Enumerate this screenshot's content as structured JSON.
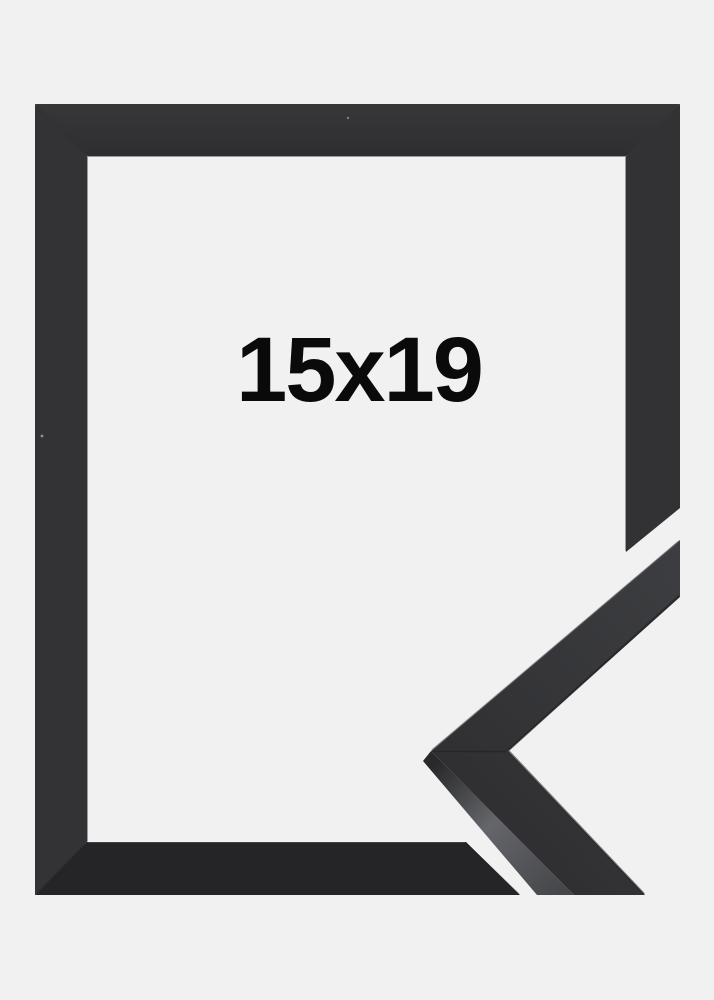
{
  "product": {
    "size_label": "15x19"
  },
  "colors": {
    "background": "#f1f1f2",
    "frame_top_light": "#373739",
    "frame_top_dark": "#2e2e30",
    "frame_left": "#333335",
    "frame_right": "#323235",
    "frame_bottom": "#252527",
    "sample_face_light": "#3c3d40",
    "sample_face_dark": "#303033",
    "sample_side_dark": "#29292b",
    "sample_side_light": "#64666b",
    "sample_side_mid": "#45464a",
    "label_text": "#0a0a0a"
  }
}
